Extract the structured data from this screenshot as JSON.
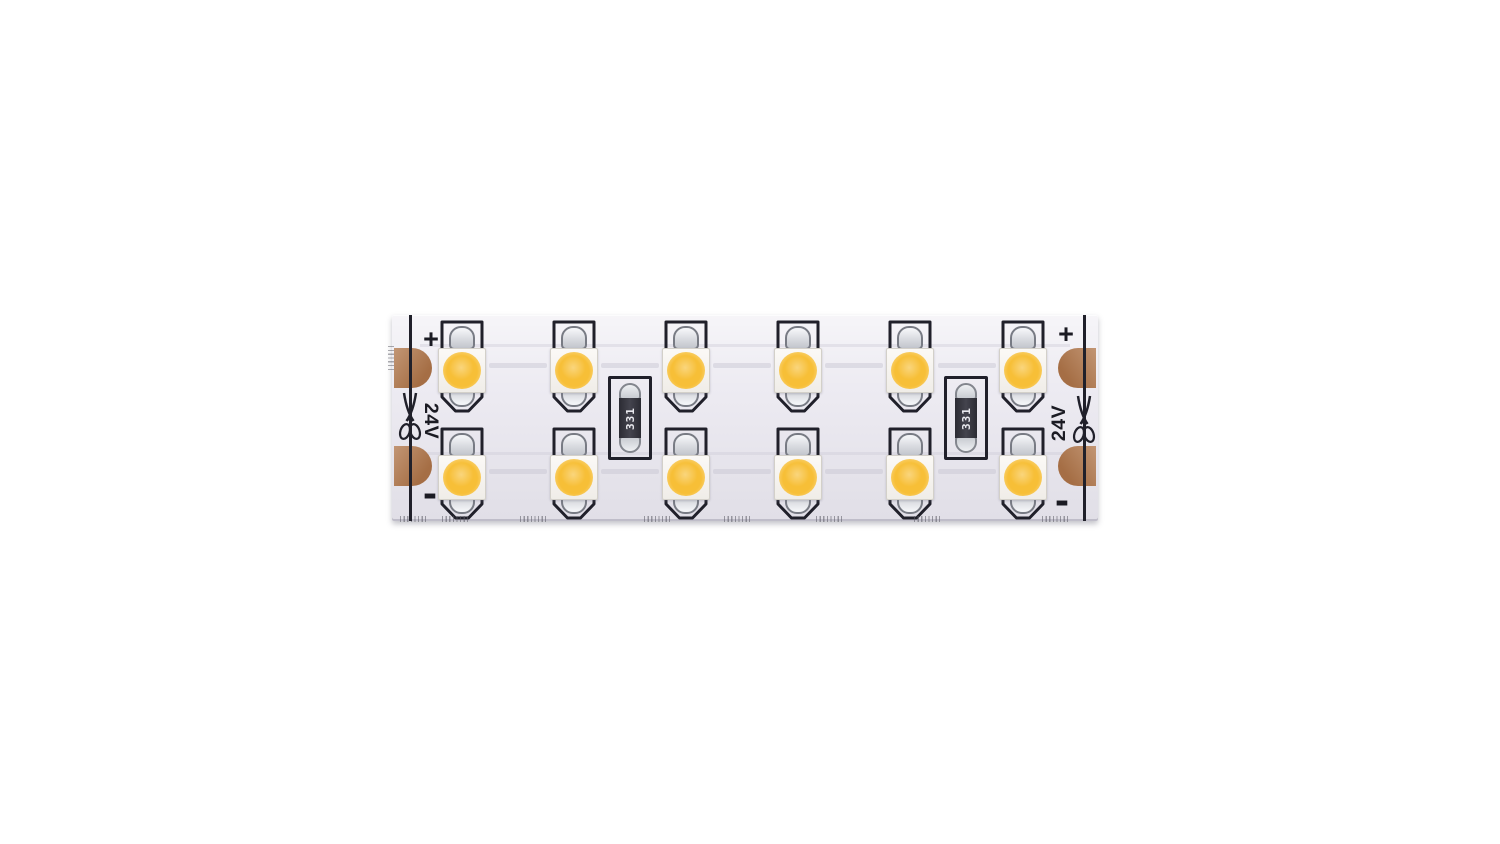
{
  "strip": {
    "resistor_code": "331",
    "terminals": {
      "left": {
        "plus": "+",
        "minus": "-",
        "voltage": "24V"
      },
      "right": {
        "plus": "+",
        "minus": "-",
        "voltage": "24V"
      }
    },
    "icons": {
      "left_cut": "scissors-icon",
      "right_cut": "scissors-icon"
    },
    "colors": {
      "pcb": "#edebf2",
      "silkscreen": "#20202a",
      "copper_pad": "#b1784d",
      "led_emitter": "#f7bf37",
      "led_package": "#f8f6f2",
      "solder": "#d5d7dc",
      "resistor_body": "#33333b",
      "resistor_code_text": "#e9e9ee",
      "marking": "#1b1b23"
    },
    "layout": {
      "bounds": {
        "left": 392,
        "top": 315,
        "width": 706,
        "height": 206
      },
      "led_columns_x": [
        70,
        182,
        294,
        406,
        518,
        631
      ],
      "led_rows_top": [
        5,
        112
      ],
      "resistor_centers_x": [
        238,
        574
      ],
      "resistor_top": 61,
      "pad_tops_y": [
        33,
        131
      ],
      "cut_lines_x": [
        17,
        691
      ],
      "edge_ticks_x": [
        8,
        50,
        128,
        252,
        332,
        424,
        522,
        650
      ],
      "trace_rows_y": [
        48,
        154
      ],
      "trace_long_rows_y": [
        29,
        137
      ]
    }
  }
}
